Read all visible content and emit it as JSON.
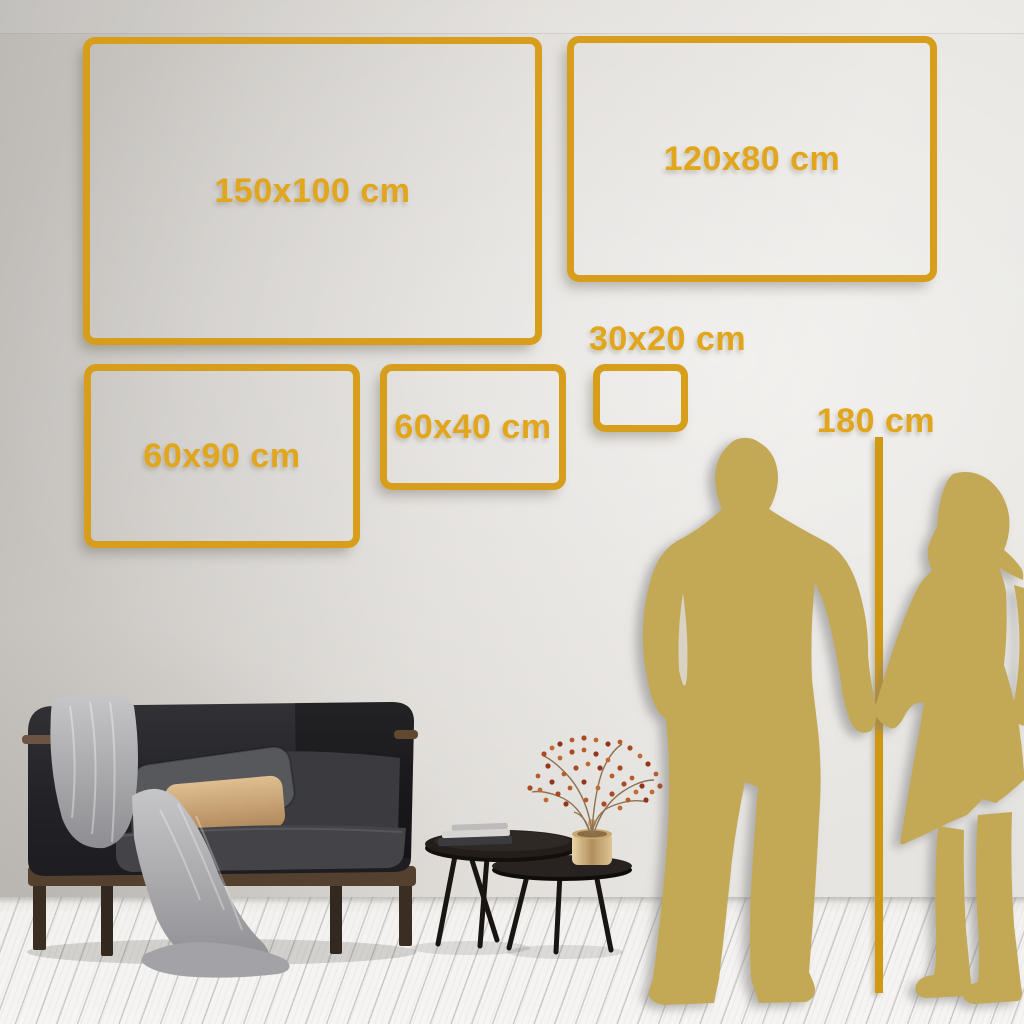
{
  "size_guide": {
    "frames": [
      {
        "label": "150x100 cm"
      },
      {
        "label": "120x80 cm"
      },
      {
        "label": "60x90 cm"
      },
      {
        "label": "60x40 cm"
      },
      {
        "label": "30x20 cm"
      }
    ],
    "height_marker": {
      "label": "180 cm"
    }
  },
  "colors": {
    "accent_gold": "#D79E1B",
    "label_gold": "#E2A61C",
    "silhouette_gold": "#C3A857",
    "wall_light": "#E8E6E2",
    "wall_dark": "#BCB9B5",
    "floor_white": "#F6F5F3",
    "sofa_charcoal": "#26262A",
    "pillow_tan": "#D8B483",
    "blanket_gray": "#A6A6AA"
  }
}
